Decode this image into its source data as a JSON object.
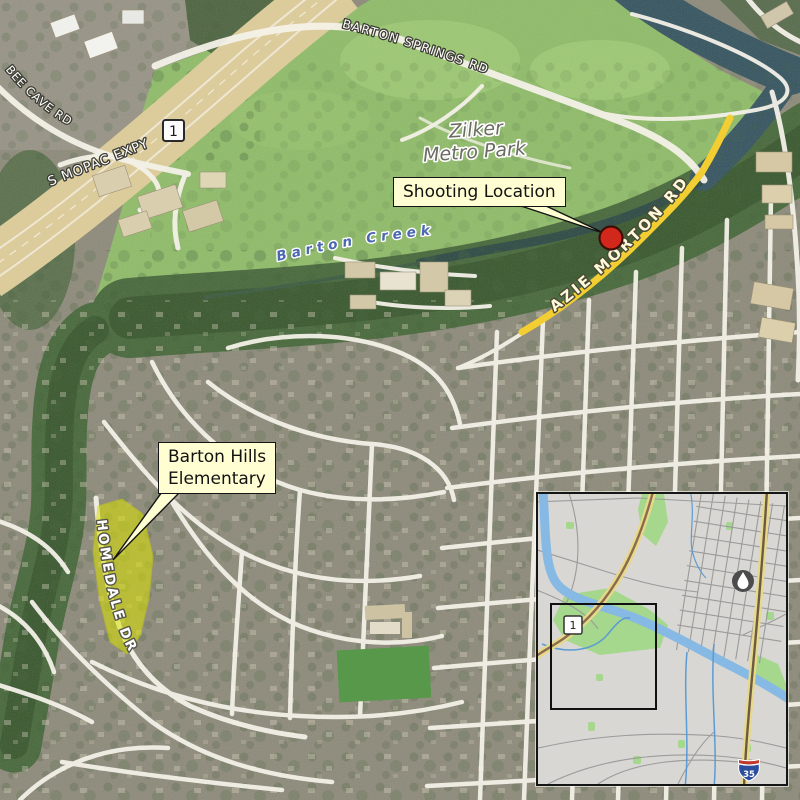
{
  "map": {
    "road_labels": {
      "barton_springs_rd": "BARTON SPRINGS RD",
      "bee_cave_rd": "BEE CAVE RD",
      "s_mopac_expy": "S MOPAC EXPY",
      "azie_morton_rd": "AZIE MORTON RD",
      "homedale_dr": "HOMEDALE DR"
    },
    "place_labels": {
      "zilker_line1": "Zilker",
      "zilker_line2": "Metro Park",
      "barton_creek": "Barton Creek"
    },
    "shields": {
      "loop_1": "1",
      "inset_loop_1": "1",
      "interstate_35": "35"
    },
    "callouts": {
      "shooting_location": {
        "text": "Shooting Location"
      },
      "barton_hills": {
        "line1": "Barton Hills",
        "line2": "Elementary"
      }
    },
    "colors": {
      "marker_red": "#D2281C",
      "school_highlight": "#DDE400",
      "callout_bg": "#FFFDD2",
      "route_yellow": "#F3CE32",
      "park_green": "#8FBC68",
      "greenbelt_green": "#47683A",
      "water_dark": "#35545F",
      "highway_tan": "#DCCB9B",
      "inset_water": "#86B9E4",
      "inset_park": "#A5D78D",
      "inset_bg": "#D8D7D3"
    }
  }
}
